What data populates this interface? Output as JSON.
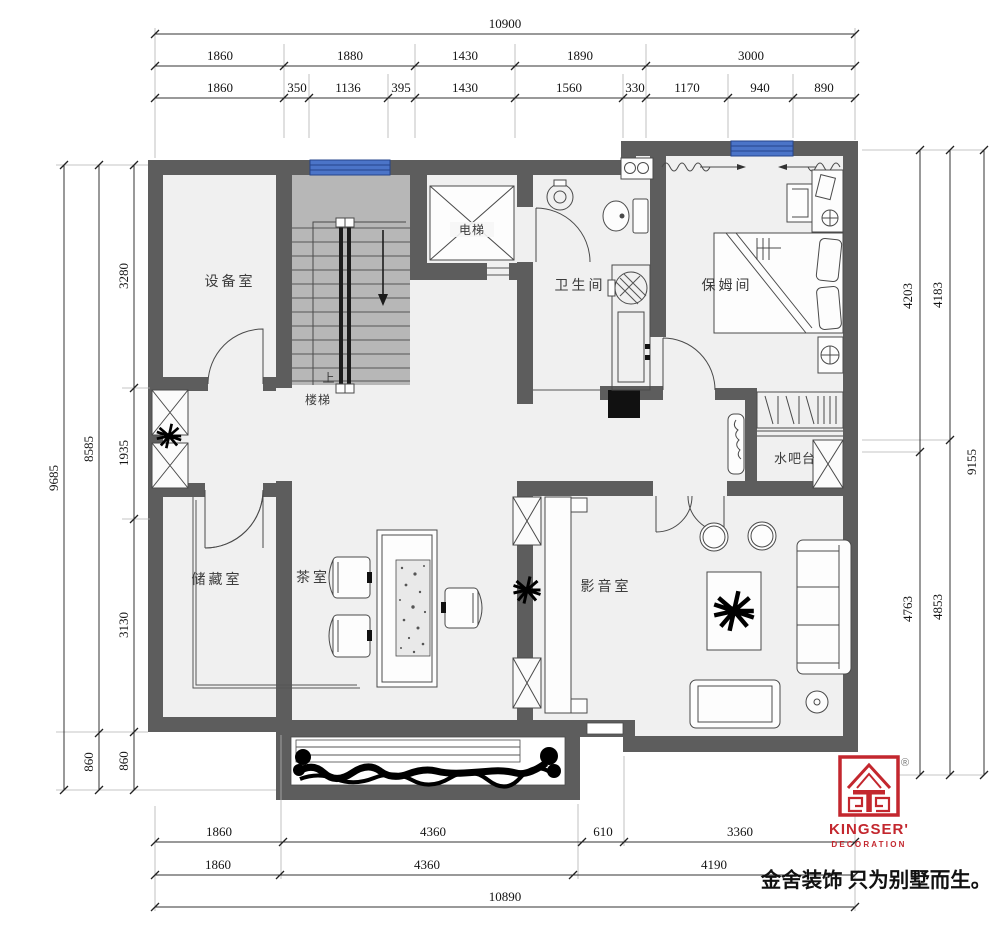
{
  "drawing": {
    "type": "floor-plan",
    "floor_fill": "#f0f0f0",
    "wall_color": "#5d5d5d",
    "stair_fill": "#b7b7b7",
    "window_color": "#4b74c8",
    "brand_red": "#c3272e"
  },
  "dims": {
    "top_total": "10900",
    "top_row2": [
      "1860",
      "1880",
      "1430",
      "1890",
      "3000"
    ],
    "top_row3": [
      "1860",
      "350",
      "1136",
      "395",
      "1430",
      "1560",
      "330",
      "1170",
      "940",
      "890"
    ],
    "bottom_row1": [
      "1860",
      "4360",
      "610",
      "3360"
    ],
    "bottom_row2": [
      "1860",
      "4360",
      "4190"
    ],
    "bottom_total": "10890",
    "left_total": "9685",
    "left_mid": [
      "8585",
      "860"
    ],
    "left_inner": [
      "3280",
      "1935",
      "3130",
      "860"
    ],
    "right_inner": [
      "4203",
      "4763"
    ],
    "right_mid": [
      "4183",
      "4853"
    ],
    "right_total": "9155"
  },
  "rooms": {
    "equipment": "设备室",
    "up": "上",
    "stairs": "楼梯",
    "elevator": "电梯",
    "bathroom": "卫生间",
    "nanny": "保姆间",
    "water_bar": "水吧台",
    "storage": "储藏室",
    "tea": "茶室",
    "media": "影音室"
  },
  "branding": {
    "brand_en": "KINGSER'",
    "brand_sub": "DECORATION",
    "registered": "®",
    "tagline": "金舍装饰 只为别墅而生。"
  }
}
